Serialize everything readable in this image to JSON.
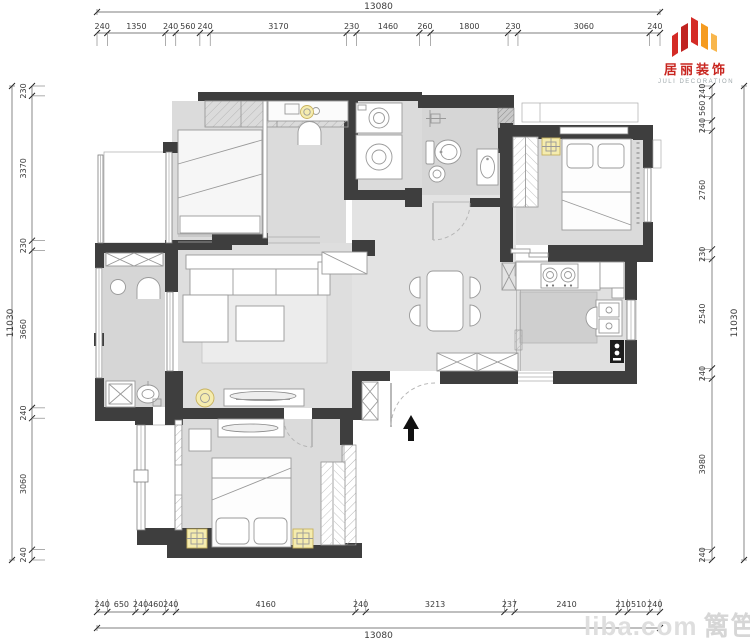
{
  "logo": {
    "brand_cn": "居丽装饰",
    "brand_en": "JULI DECORATION"
  },
  "watermark": {
    "latin": "liba.com",
    "cn": "篱笆网"
  },
  "plan": {
    "dimensions": {
      "top": {
        "total": "13080",
        "segments": [
          240,
          1350,
          240,
          560,
          240,
          3170,
          230,
          1460,
          260,
          1800,
          230,
          3060,
          240
        ]
      },
      "bottom": {
        "total": "13080",
        "segments": [
          240,
          650,
          240,
          460,
          240,
          4160,
          240,
          3213,
          237,
          2410,
          210,
          510,
          240
        ]
      },
      "left": {
        "total": "11030",
        "segments": [
          230,
          3370,
          230,
          3660,
          240,
          3060,
          240
        ]
      },
      "right": {
        "total": "11030",
        "segments": [
          240,
          560,
          240,
          2760,
          230,
          2540,
          240,
          3980,
          240
        ]
      }
    }
  }
}
